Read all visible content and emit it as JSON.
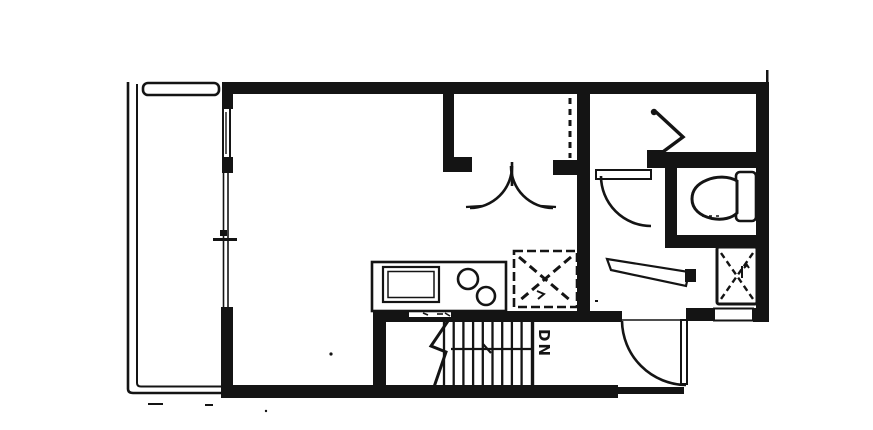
{
  "meta": {
    "title": "Scanned apartment floor plan",
    "drawing_type": "architectural floor plan, black ink scan on white paper"
  },
  "colors": {
    "ink": "#141414",
    "paper": "#ffffff"
  },
  "labels": {
    "stair_direction": "DN"
  },
  "rooms": [
    {
      "name": "balcony",
      "position": "left edge, railed deck"
    },
    {
      "name": "main-living-room",
      "position": "center, open studio space"
    },
    {
      "name": "closet",
      "position": "top center, double swing doors"
    },
    {
      "name": "hall-entry",
      "position": "right of kitchen, entry door at bottom"
    },
    {
      "name": "toilet-room",
      "position": "right side, small room with toilet"
    },
    {
      "name": "upper-right-room",
      "position": "top right, with zigzag fitting symbol"
    },
    {
      "name": "stair-hall",
      "position": "bottom center, stairs going down"
    }
  ],
  "fixtures": [
    {
      "name": "kitchen-counter",
      "details": "counter with cooktop rectangle and two sink bowls"
    },
    {
      "name": "dishwasher-square",
      "details": "dashed square with dashed X diagonals"
    },
    {
      "name": "washer-square",
      "details": "small square with dashed X and glyph, lower right"
    },
    {
      "name": "toilet",
      "details": "tank against right wall, bowl facing left"
    },
    {
      "name": "stairs",
      "details": "nine treads, break line at left, direction line with DN label"
    },
    {
      "name": "balcony-railing",
      "details": "double-line rail with rounded top rail plate"
    }
  ],
  "doors": [
    {
      "name": "entry-door",
      "details": "bottom wall opening, leaf shown open downward with quarter-circle swing"
    },
    {
      "name": "toilet-room-door",
      "details": "leaf with quarter-circle swing into hall"
    },
    {
      "name": "closet-double-doors",
      "details": "two quarter arcs meeting at center stile"
    },
    {
      "name": "balcony-slider",
      "details": "thin double line in left wall with meeting-rail tick"
    }
  ],
  "windows": [
    {
      "name": "left-wall-window",
      "details": "slot with center glass line, upper left wall"
    },
    {
      "name": "bottom-right-window",
      "details": "white slot in lower right wall"
    }
  ]
}
